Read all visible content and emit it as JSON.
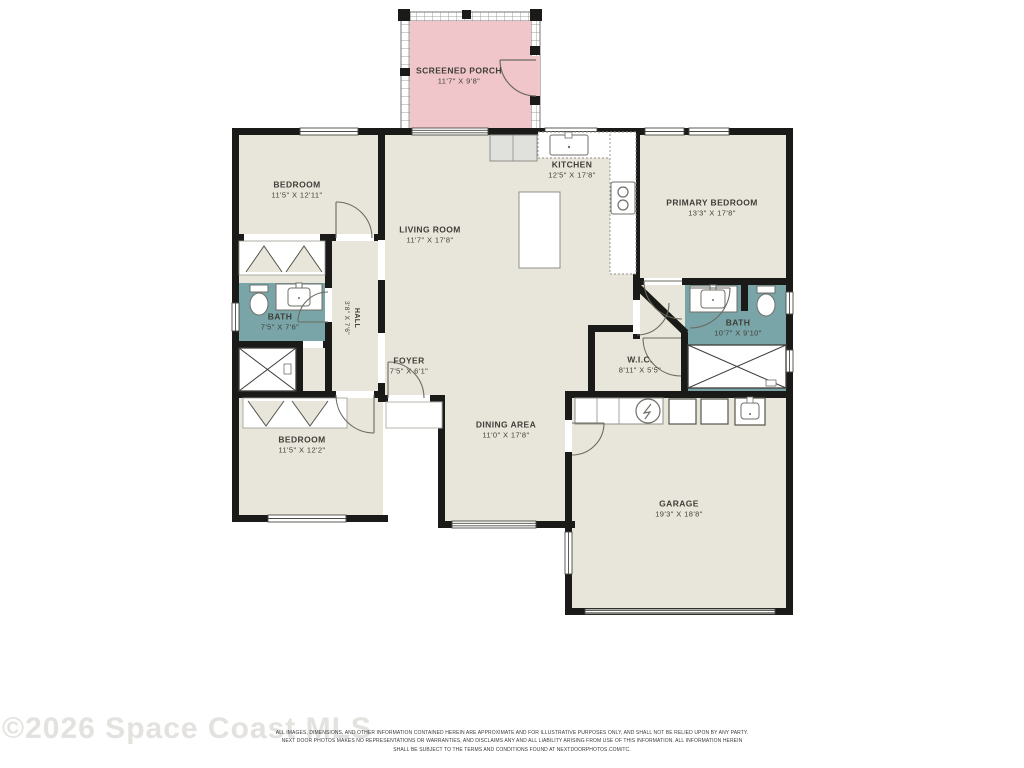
{
  "watermark": "©2026 Space Coast MLS",
  "disclaimer": {
    "line1": "ALL IMAGES, DIMENSIONS, AND OTHER INFORMATION CONTAINED HEREIN ARE APPROXIMATE AND FOR ILLUSTRATIVE PURPOSES ONLY, AND SHALL NOT BE RELIED UPON BY ANY PARTY.",
    "line2": "NEXT DOOR PHOTOS MAKES NO REPRESENTATIONS OR WARRANTIES, AND DISCLAIMS ANY AND ALL LIABILITY ARISING FROM USE OF THIS INFORMATION. ALL INFORMATION HEREIN",
    "line3": "SHALL BE SUBJECT TO THE TERMS AND CONDITIONS FOUND AT NEXTDOORPHOTOS.COM/TC."
  },
  "colors": {
    "wall": "#1a1a18",
    "room_fill": "#e8e6da",
    "bath_fill": "#7aa5a8",
    "porch_fill": "#f0c6ca"
  },
  "rooms": {
    "screened_porch": {
      "name": "SCREENED PORCH",
      "dims": "11'7\" X 9'8\""
    },
    "bedroom_top": {
      "name": "BEDROOM",
      "dims": "11'5\" X 12'11\""
    },
    "living_room": {
      "name": "LIVING ROOM",
      "dims": "11'7\" X 17'8\""
    },
    "kitchen": {
      "name": "KITCHEN",
      "dims": "12'5\" X 17'8\""
    },
    "primary_bedroom": {
      "name": "PRIMARY BEDROOM",
      "dims": "13'3\" X 17'8\""
    },
    "bath_left": {
      "name": "BATH",
      "dims": "7'5\" X 7'6\""
    },
    "hall": {
      "name": "HALL",
      "dims": "3'8\" X 7'6\""
    },
    "foyer": {
      "name": "FOYER",
      "dims": "7'5\" X 6'1\""
    },
    "wic": {
      "name": "W.I.C.",
      "dims": "8'11\" X 5'5\""
    },
    "bath_right": {
      "name": "BATH",
      "dims": "10'7\" X 9'10\""
    },
    "dining_area": {
      "name": "DINING AREA",
      "dims": "11'0\" X 17'8\""
    },
    "bedroom_bottom": {
      "name": "BEDROOM",
      "dims": "11'5\" X 12'2\""
    },
    "garage": {
      "name": "GARAGE",
      "dims": "19'3\" X 18'8\""
    }
  }
}
